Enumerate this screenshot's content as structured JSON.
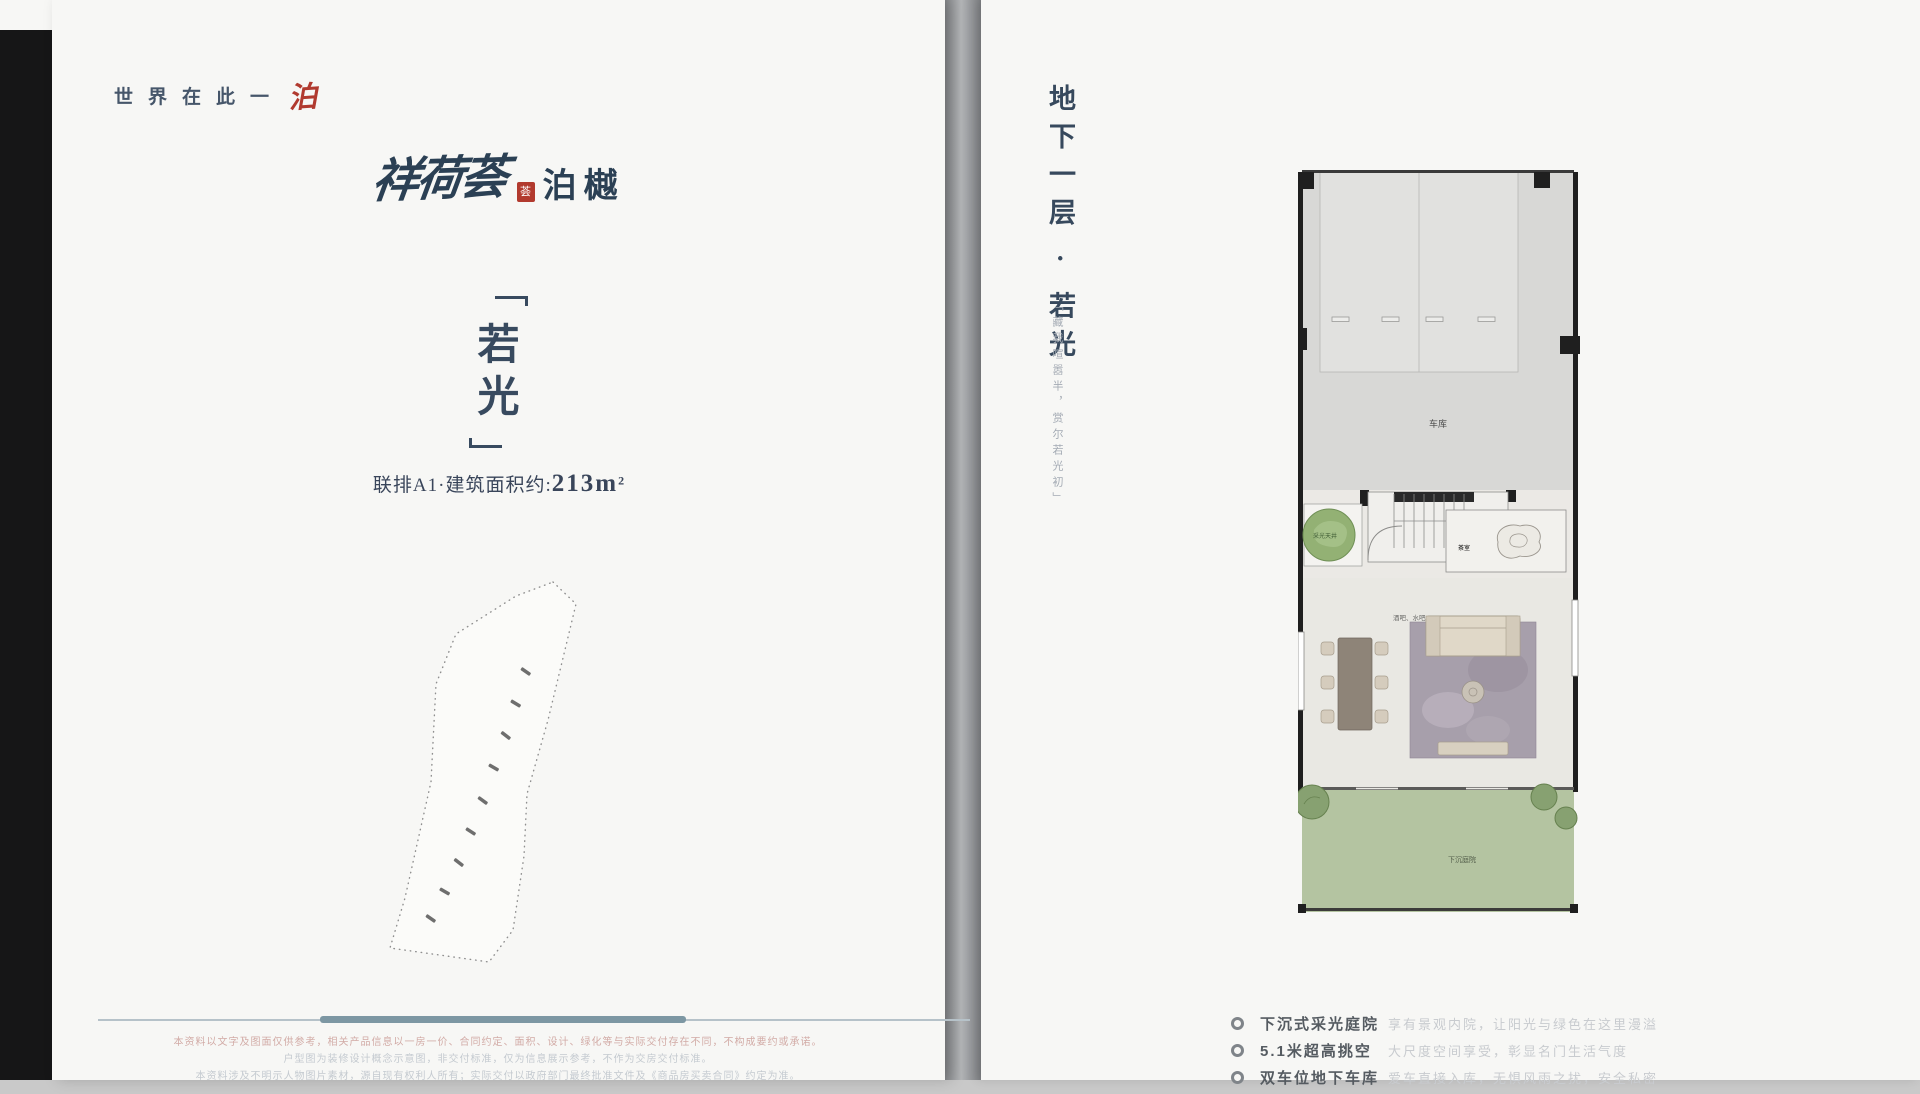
{
  "page_left": {
    "slogan": {
      "chars": "世界在此一",
      "accent": "泊"
    },
    "logo": {
      "calligraphy": "祥荷荟",
      "seal_char": "荟",
      "mark": "泊樾"
    },
    "unit_title": {
      "char1": "若",
      "char2": "光"
    },
    "area_line": {
      "prefix": "联排A1·建筑面积约:",
      "value": "213",
      "unit": "m",
      "sup": "2"
    },
    "disclaimer": {
      "line1": "本资料以文字及图面仅供参考，相关产品信息以一房一价、合同约定、面积、设计、绿化等与实际交付存在不同，不构成要约或承诺。",
      "line2": "户型图为装修设计概念示意图，非交付标准，仅为信息展示参考，不作为交房交付标准。",
      "line3": "本资料涉及不明示人物图片素材，源自现有权利人所有；实际交付以政府部门最终批准文件及《商品房买卖合同》约定为准。"
    }
  },
  "page_right": {
    "vertical_title": "地下一层 · 若光",
    "vertical_quote": "「藏我喧嚣半，赏尔若光初」",
    "floor_plan_labels": {
      "garage": "车库",
      "planter": "采光天井",
      "tea_room": "茶室",
      "bar": "酒吧、水吧",
      "garden": "下沉庭院"
    },
    "features": [
      {
        "title": "下沉式采光庭院",
        "desc": "享有景观内院，让阳光与绿色在这里漫溢"
      },
      {
        "title": "5.1米超高挑空",
        "desc": "大尺度空间享受，彰显名门生活气度"
      },
      {
        "title": "双车位地下车库",
        "desc": "爱车直接入库，无惧风雨之扰，安全私密"
      }
    ]
  },
  "colors": {
    "accent_red": "#b23a2e",
    "title_blue": "#37495d",
    "rule_blue": "#7d97a3",
    "garden_green": "#b4c4a1",
    "page_bg": "#f7f7f5"
  }
}
